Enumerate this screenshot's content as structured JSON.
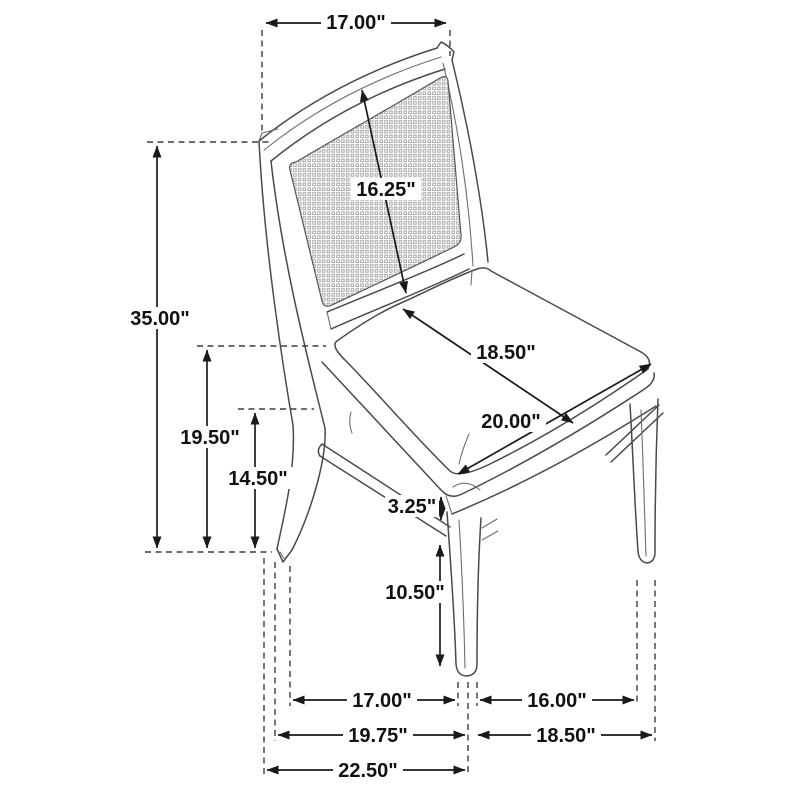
{
  "diagram": {
    "type": "furniture-dimension-drawing",
    "subject": "cane-back dining side chair with upholstered seat, three-quarter view",
    "units": "inches",
    "labels": {
      "back_width": "17.00\"",
      "back_panel_height": "16.25\"",
      "overall_height": "35.00\"",
      "seat_depth": "18.50\"",
      "seat_width": "20.00\"",
      "floor_to_seat_top": "19.50\"",
      "floor_to_seat_frame": "14.50\"",
      "frame_to_stretcher": "3.25\"",
      "stretcher_to_floor": "10.50\"",
      "footprint_front_span": "17.00\"",
      "footprint_side_span": "16.00\"",
      "footprint_depth_mid": "19.75\"",
      "footprint_side_depth": "18.50\"",
      "overall_depth": "22.50\""
    }
  }
}
